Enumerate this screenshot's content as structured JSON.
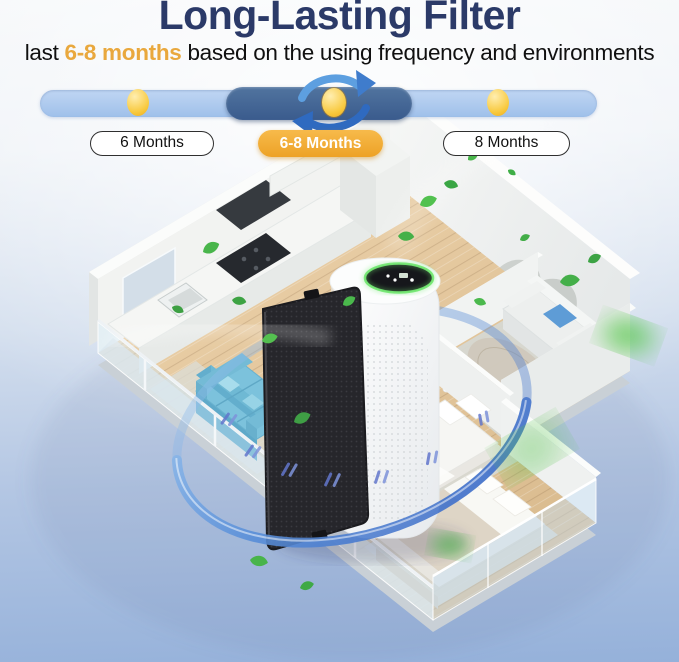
{
  "header": {
    "title": "Long-Lasting Filter",
    "subtitle": {
      "prefix": "last ",
      "highlight": "6-8 months",
      "suffix": " based on the using frequency and environments"
    }
  },
  "timeline": {
    "options": [
      {
        "label": "6 Months",
        "selected": false
      },
      {
        "label": "6-8 Months",
        "selected": true
      },
      {
        "label": "8 Months",
        "selected": false
      }
    ],
    "selected_option": "6-8 Months",
    "icon": "cycle-arrows-icon"
  },
  "illustration": {
    "alt": "Isometric apartment cutaway with white air purifier, removable black filter panel, blue circulating airflow ring and green leaves",
    "elements": [
      "apartment-floorplan",
      "air-purifier",
      "filter-panel",
      "airflow-ring",
      "green-leaves",
      "balcony-railing",
      "kitchen-counter",
      "blue-sofa",
      "white-sofa",
      "beds"
    ]
  },
  "colors": {
    "bgTop": "#f6f8fa",
    "bgBottom": "#95b1da",
    "title": "#2b3a68",
    "highlight": "#e9a83d",
    "track": "#a9c6ec",
    "segment": "#40618f",
    "dot": "#f8c83e",
    "pillSelectedBg": "#f0a832",
    "pillBorder": "#2f2f2f",
    "leaf": "#45b249",
    "airflow": "#4c79cc",
    "filterPanel": "#26262b"
  }
}
